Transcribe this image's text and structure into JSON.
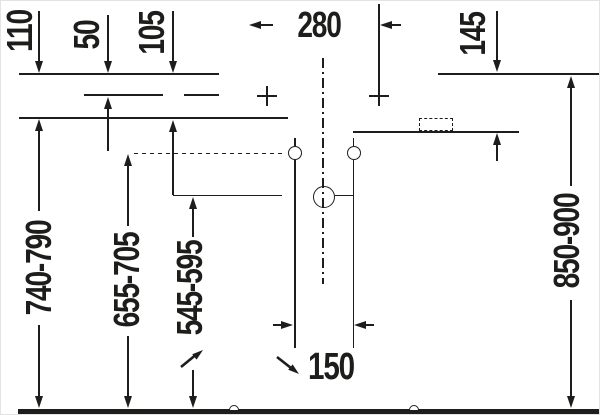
{
  "colors": {
    "line": "#1d1d1b",
    "background": "#ffffff"
  },
  "dimensions": {
    "d110": "110",
    "d50": "50",
    "d105": "105",
    "d280": "280",
    "d145": "145",
    "d740": "740-790",
    "d655": "655-705",
    "d545": "545-595",
    "d850": "850-900",
    "d150": "150"
  }
}
